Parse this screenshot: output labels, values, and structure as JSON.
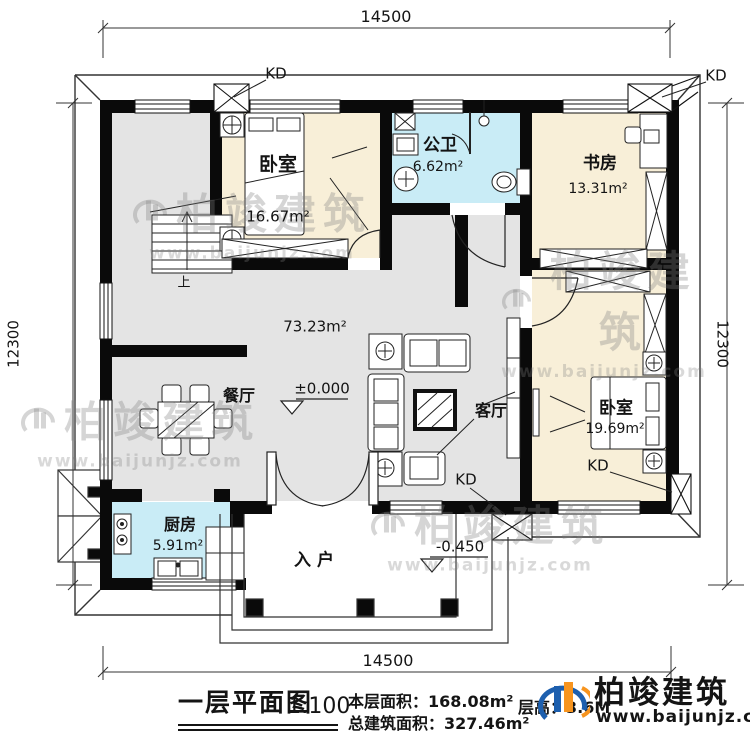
{
  "dims": {
    "top": "14500",
    "bottom": "14500",
    "left": "12300",
    "right": "12300"
  },
  "window_label": "KD",
  "stairs_up": "上",
  "levels": {
    "main": "±0.000",
    "entry": "-0.450"
  },
  "rooms": {
    "bedroom1": {
      "name": "卧室",
      "area": "16.67m²"
    },
    "bathroom": {
      "name": "公卫",
      "area": "6.62m²"
    },
    "study": {
      "name": "书房",
      "area": "13.31m²"
    },
    "hall": {
      "area": "73.23m²"
    },
    "dining": {
      "name": "餐厅"
    },
    "living": {
      "name": "客厅"
    },
    "bedroom2": {
      "name": "卧室",
      "area": "19.69m²"
    },
    "kitchen": {
      "name": "厨房",
      "area": "5.91m²"
    },
    "entry": {
      "name": "入户"
    }
  },
  "title_block": {
    "title": "一层平面图",
    "scale": "1:100",
    "floor_area_label": "本层面积：",
    "floor_area_value": "168.08m²",
    "total_area_label": "总建筑面积：",
    "total_area_value": "327.46m²",
    "storey_note": "层高：3.6M"
  },
  "brand": {
    "name": "柏竣建筑",
    "site": "www.baijunjz.com"
  },
  "watermark": {
    "name": "柏竣建筑",
    "site": "www.baijunjz.com"
  },
  "colors": {
    "bedroom_fill": "#f8efd8",
    "wet_fill": "#c9ecf6",
    "hall_fill": "#e4e4e4",
    "wall": "#0a0a0a",
    "brand_blue": "#1d5fae",
    "brand_orange": "#f7941e"
  }
}
